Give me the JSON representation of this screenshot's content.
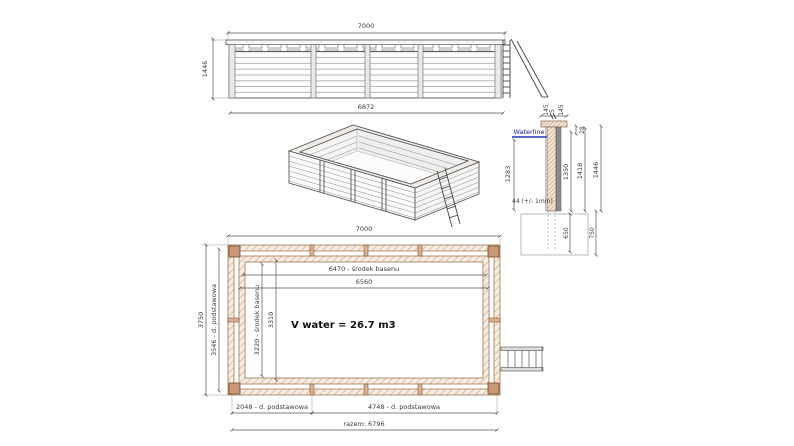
{
  "drawing": {
    "subject": "wooden-pool-technical-drawing",
    "colors": {
      "waterline": "#2233bb",
      "wood_hatch": "#c49a7a",
      "line": "#555555"
    }
  },
  "elevation": {
    "dim_top": "7000",
    "dim_left": "1446",
    "dim_bottom": "6872"
  },
  "section": {
    "waterline": "Waterline",
    "dim_cap_a": "145",
    "dim_cap_gap": "5",
    "dim_cap_b": "145",
    "dim_28": "28",
    "dim_1283": "1283",
    "plank_note": "44 (+/- 1mm)",
    "dim_1350": "1350",
    "dim_1418": "1418",
    "dim_1446": "1446",
    "dim_650": "650",
    "dim_750": "750"
  },
  "plan": {
    "dim_top": "7000",
    "dim_center": "6470 - środek basenu",
    "dim_inner": "6560",
    "dim_width_outer": "3750",
    "dim_width_base": "3546 - d. podstawowa",
    "dim_width_center": "3220 - środek basenu",
    "dim_width_inner": "3310",
    "volume": "V water = 26.7 m3",
    "dim_base_left": "2048 - d. podstawowa",
    "dim_base_right": "4748 - d. podstawowa",
    "dim_total": "razem: 6796"
  }
}
